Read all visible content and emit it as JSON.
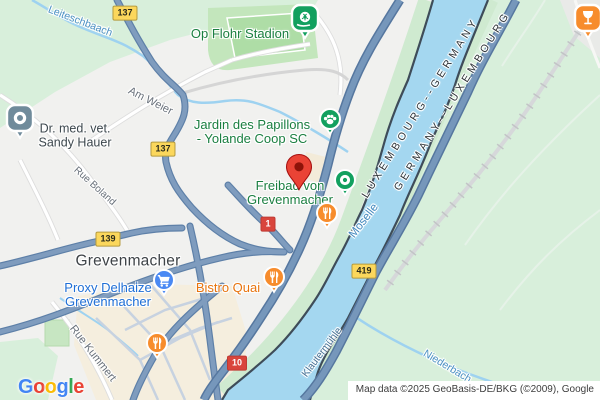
{
  "app": {
    "name": "map-view",
    "place": "Grevenmacher"
  },
  "colors": {
    "land": "#F1F1EF",
    "vegetation": "#D8EFDB",
    "park": "#C3E6BC",
    "urban_beige": "#F5EEDE",
    "water": "#A4D7F0",
    "border_line": "#3E4C59",
    "road_major": "#7697BB",
    "road_major_casing": "#56779F",
    "road_medium": "#7F9CBE",
    "road_medium_casing": "#5E80A8",
    "poi_green": "#12A05F",
    "poi_orange": "#F78C2C",
    "poi_blue": "#4A89F3",
    "poi_gray": "#708B9B",
    "marker_red": "#EA4335",
    "marker_red_inner": "#8E1309",
    "badge_yellow": "#FBD75C",
    "badge_red": "#D9453C",
    "label_green": "#1B7F41",
    "label_blue": "#1F6FD6",
    "label_orange": "#E8740E"
  },
  "places": {
    "city": "Grevenmacher"
  },
  "pois": {
    "stadium": {
      "label": "Op Flohr Stadion"
    },
    "jardin": {
      "line1": "Jardin des Papillons",
      "line2": "- Yolande Coop SC"
    },
    "freibad": {
      "line1": "Freibad von",
      "line2": "Grevenmacher"
    },
    "vet": {
      "line1": "Dr. med. vet.",
      "line2": "Sandy Hauer"
    },
    "proxy": {
      "line1": "Proxy Delhaize",
      "line2": "Grevenmacher"
    },
    "bistro": {
      "label": "Bistro Quai"
    }
  },
  "roads": {
    "am_weier": "Am Weier",
    "rue_boland": "Rue Boland",
    "rue_kummert": "Rue Kummert",
    "klautermuhle": "Klautermühle"
  },
  "waters": {
    "moselle": "Moselle",
    "leiteschbaach": "Leiteschbaach",
    "niederbach": "Niederbach"
  },
  "borders": {
    "label1": "LUXEMBOURG--GERMANY",
    "label2": "GERMANY--LUXEMBOURG"
  },
  "badges": {
    "b137a": "137",
    "b137b": "137",
    "b139": "139",
    "b419": "419",
    "b1": "1",
    "b10": "10"
  },
  "logo": {
    "l1": "G",
    "l2": "o",
    "l3": "o",
    "l4": "g",
    "l5": "l",
    "l6": "e"
  },
  "attribution": {
    "text": "Map data ©2025 GeoBasis-DE/BKG (©2009), Google"
  }
}
